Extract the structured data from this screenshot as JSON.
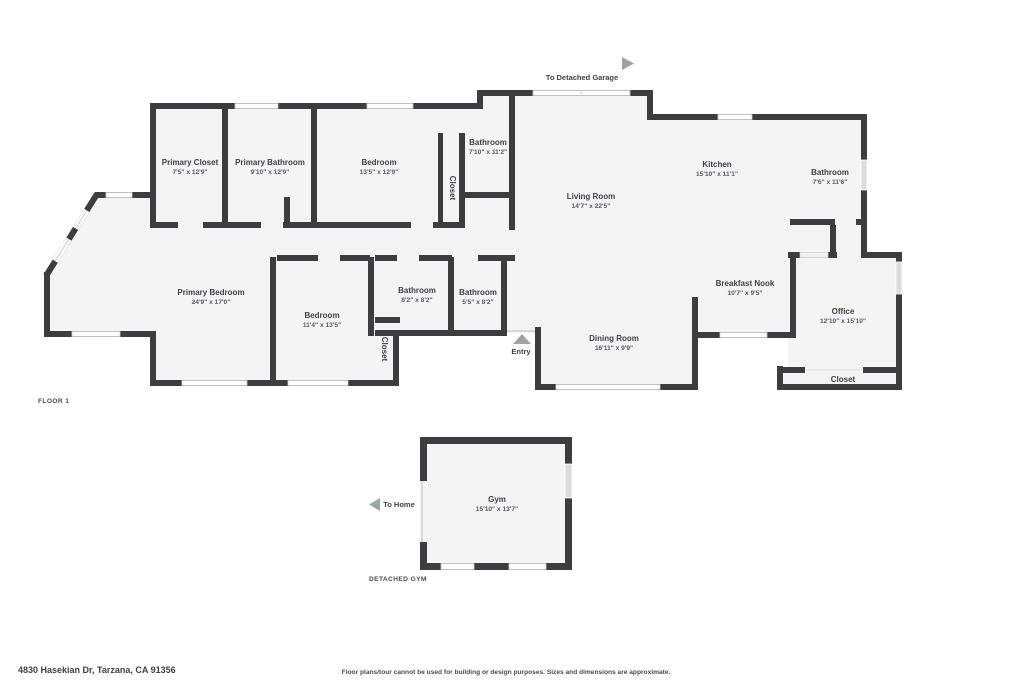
{
  "page": {
    "floor1_label": "FLOOR 1",
    "detached_gym_label": "DETACHED GYM",
    "to_detached_garage": "To Detached Garage",
    "to_home": "To Home",
    "entry": "Entry",
    "address": "4830 Hasekian Dr, Tarzana, CA 91356",
    "disclaimer": "Floor plans/tour cannot be used for building or design purposes. Sizes and dimensions are approximate."
  },
  "rooms": {
    "primary_closet": {
      "name": "Primary Closet",
      "dims": "7'5\" x 12'9\""
    },
    "primary_bathroom": {
      "name": "Primary Bathroom",
      "dims": "9'10\" x 12'9\""
    },
    "bedroom_top": {
      "name": "Bedroom",
      "dims": "13'5\" x 12'9\""
    },
    "hall_closet": {
      "name": "Closet"
    },
    "hall_bathroom": {
      "name": "Bathroom",
      "dims": "7'10\" x 11'2\""
    },
    "living_room": {
      "name": "Living Room",
      "dims": "14'7\" x 22'5\""
    },
    "kitchen": {
      "name": "Kitchen",
      "dims": "15'10\" x 11'1\""
    },
    "right_bathroom": {
      "name": "Bathroom",
      "dims": "7'6\" x 11'6\""
    },
    "primary_bedroom": {
      "name": "Primary Bedroom",
      "dims": "24'9\" x 17'0\""
    },
    "bedroom_bottom": {
      "name": "Bedroom",
      "dims": "11'4\" x 13'5\""
    },
    "bathroom_82": {
      "name": "Bathroom",
      "dims": "8'2\" x 8'2\""
    },
    "bathroom_55": {
      "name": "Bathroom",
      "dims": "5'5\" x 8'2\""
    },
    "bedroom_closet": {
      "name": "Closet"
    },
    "dining_room": {
      "name": "Dining Room",
      "dims": "16'11\" x 9'9\""
    },
    "breakfast_nook": {
      "name": "Breakfast Nook",
      "dims": "10'7\" x 9'5\""
    },
    "office": {
      "name": "Office",
      "dims": "12'10\" x 15'10\""
    },
    "office_closet": {
      "name": "Closet"
    },
    "gym": {
      "name": "Gym",
      "dims": "15'10\" x 13'7\""
    }
  },
  "colors": {
    "wall": "#3d3d40",
    "room_fill": "#f4f4f4",
    "arrow": "#9ea3a8",
    "window_gray": "#dcdcdc",
    "text": "#3f3f46"
  }
}
